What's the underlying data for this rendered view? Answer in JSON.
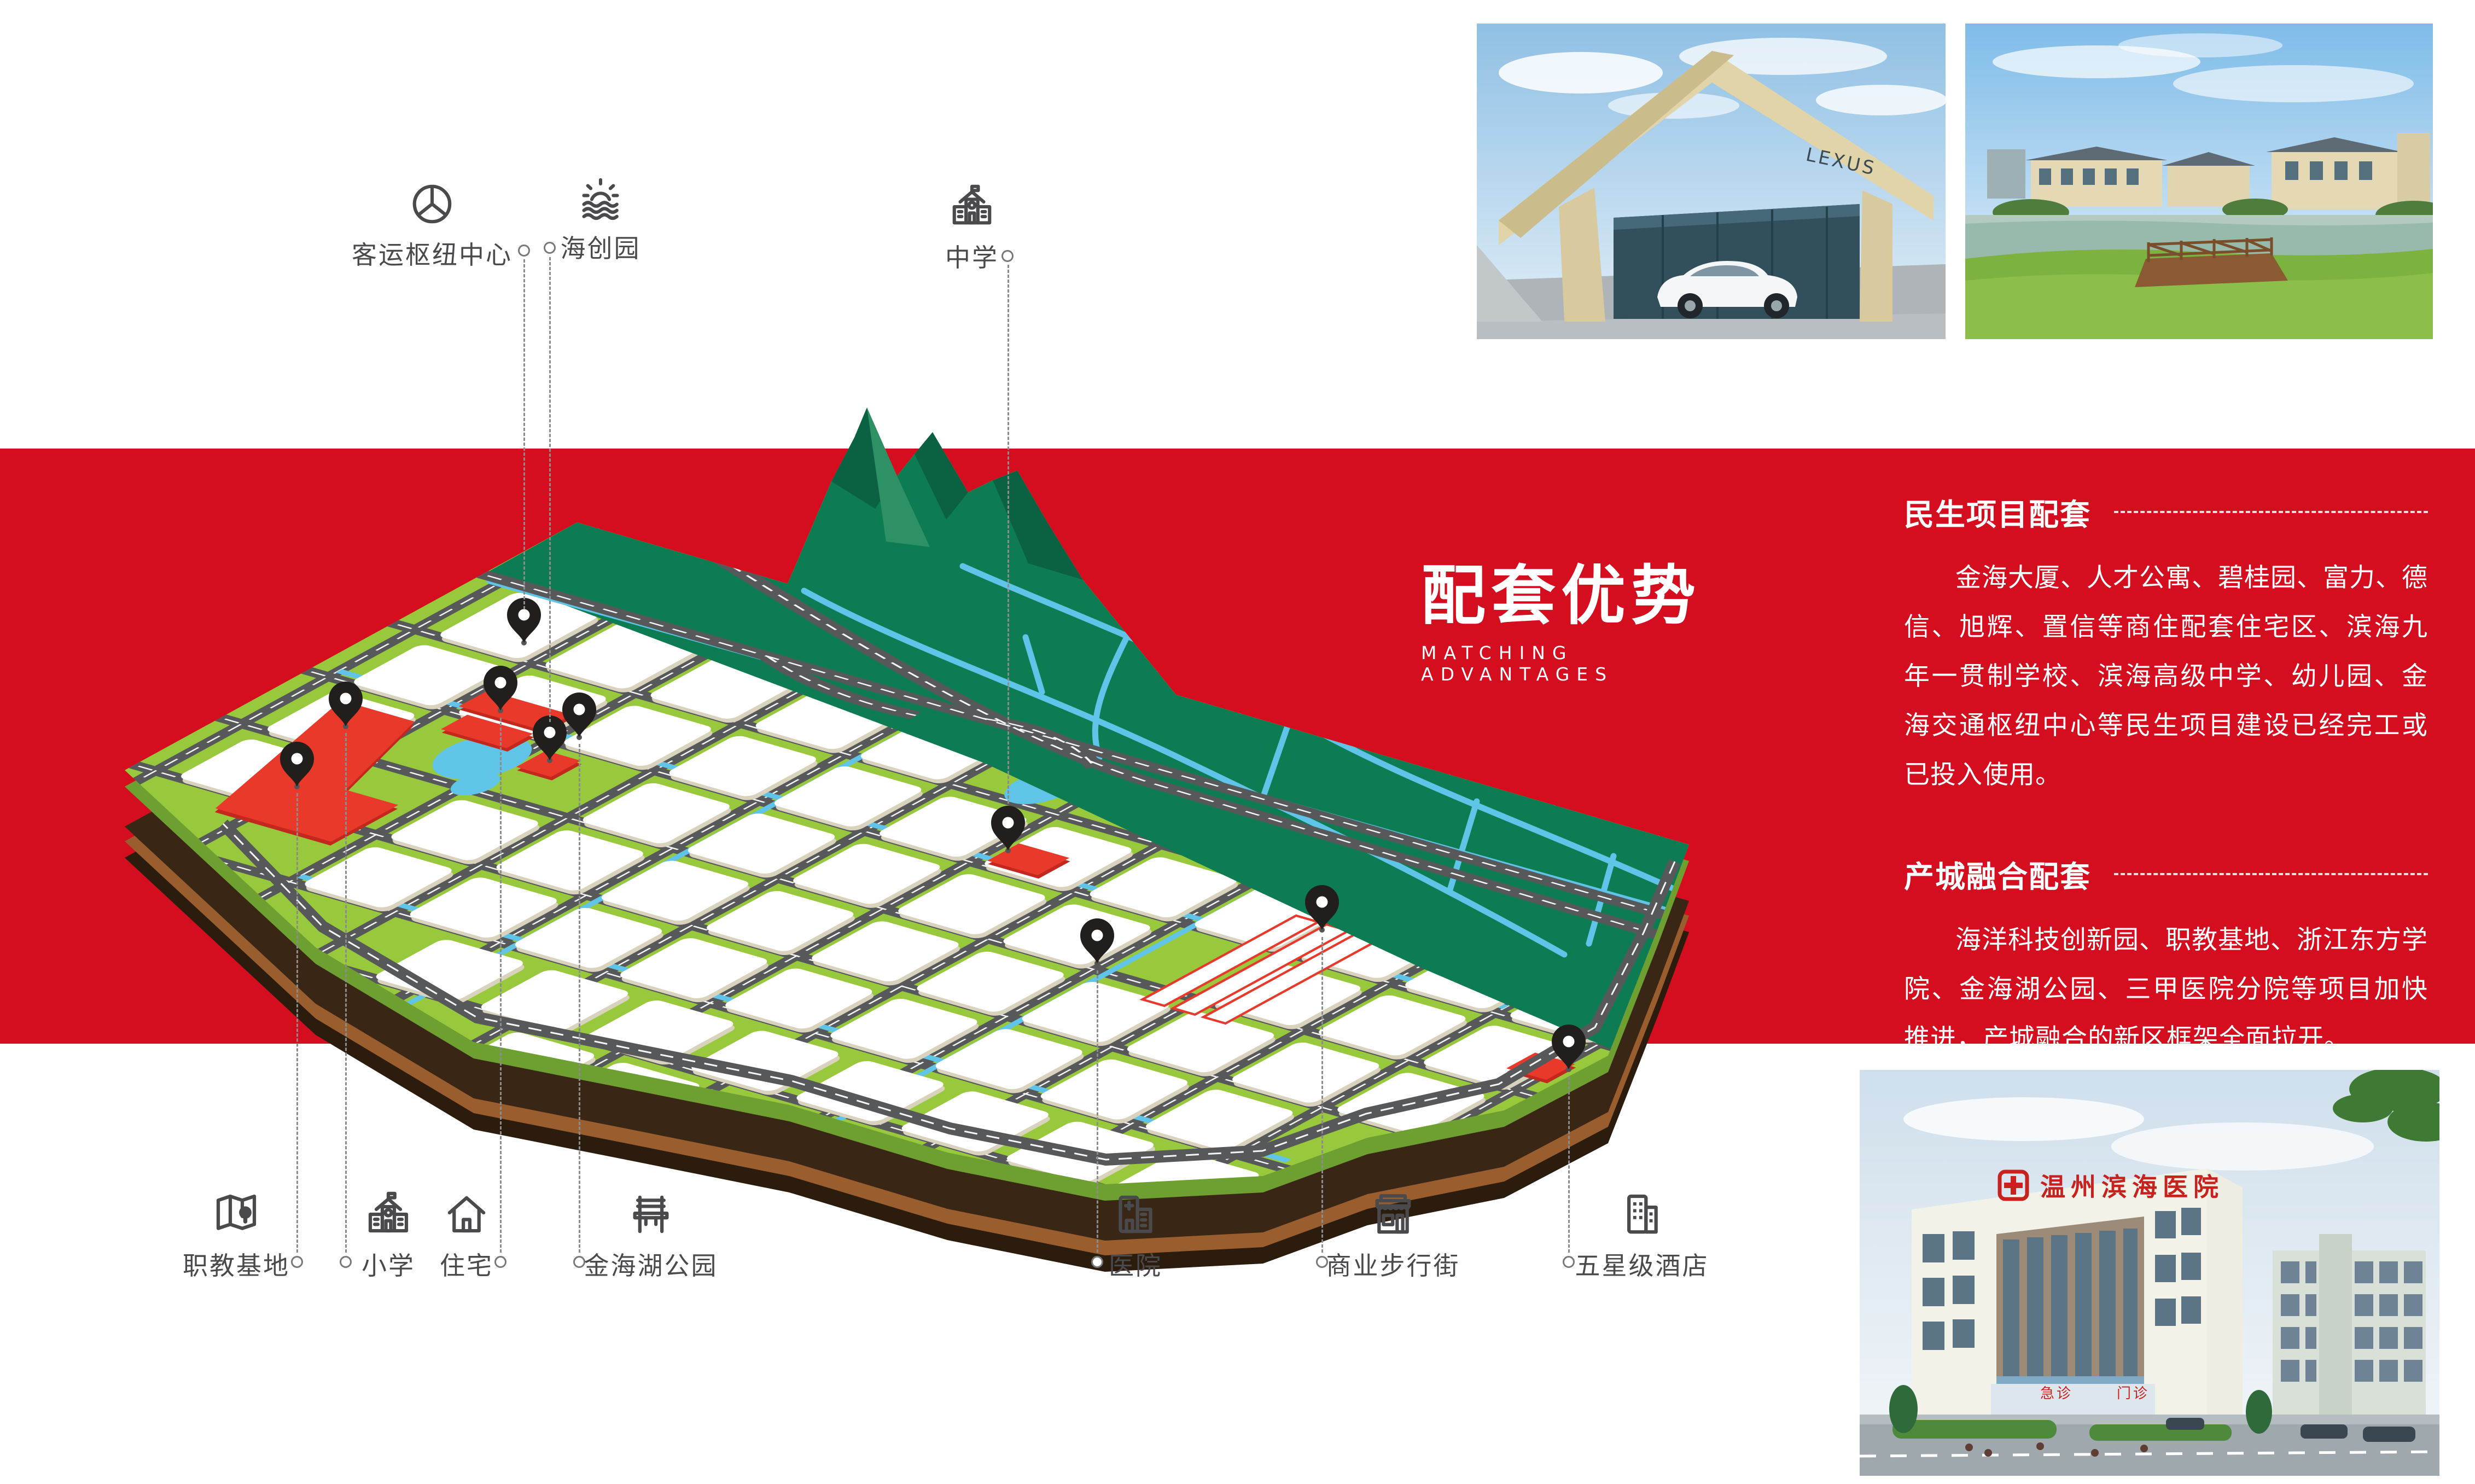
{
  "hero": {
    "title": "配套优势",
    "subtitle": "MATCHING ADVANTAGES"
  },
  "sections": [
    {
      "heading": "民生项目配套",
      "body": "金海大厦、人才公寓、碧桂园、富力、德信、旭辉、置信等商住配套住宅区、滨海九年一贯制学校、滨海高级中学、幼儿园、金海交通枢纽中心等民生项目建设已经完工或已投入使用。"
    },
    {
      "heading": "产城融合配套",
      "body": "海洋科技创新园、职教基地、浙江东方学院、金海湖公园、三甲医院分院等项目加快推进，产城融合的新区框架全面拉开。"
    }
  ],
  "labels": {
    "top": [
      {
        "label": "客运枢纽中心"
      },
      {
        "label": "海创园"
      },
      {
        "label": "中学"
      }
    ],
    "bottom": [
      {
        "label": "职教基地"
      },
      {
        "label": "小学"
      },
      {
        "label": "住宅"
      },
      {
        "label": "金海湖公园"
      },
      {
        "label": "医院"
      },
      {
        "label": "商业步行街"
      },
      {
        "label": "五星级酒店"
      }
    ]
  },
  "photos": {
    "dealership_sign": "LEXUS",
    "hospital_sign": "温州滨海医院",
    "hospital_entrance_left": "急诊",
    "hospital_entrance_right": "门诊"
  },
  "colors": {
    "band_red": "#D40E1F",
    "parcel_red": "#E8392B",
    "map_green": "#98C93C",
    "mountain_green": "#0E7C52",
    "water_blue": "#5FC4E8",
    "road_gray": "#57585A",
    "soil_brown": "#3A2615"
  }
}
